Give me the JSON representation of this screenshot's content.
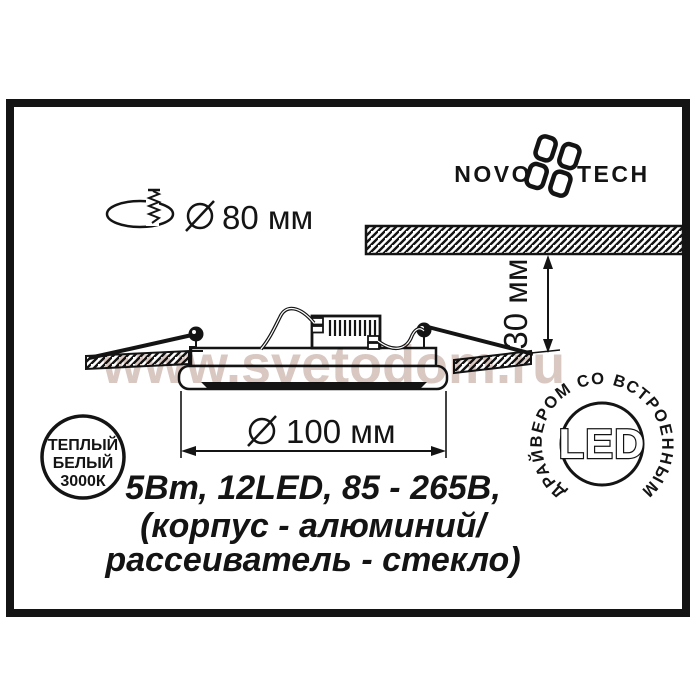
{
  "logo": {
    "word_left": "NOVO",
    "word_right": "TECH"
  },
  "dimensions": {
    "cutout_label": "80 мм",
    "depth_label": "30 мм",
    "width_label": "100 мм"
  },
  "specs": {
    "line1": "5Вт, 12LED, 85 - 265В,",
    "line2": "(корпус - алюминий/",
    "line3": "рассеиватель - стекло)"
  },
  "warm_badge": {
    "line1": "ТЕПЛЫЙ",
    "line2": "БЕЛЫЙ",
    "line3": "3000К"
  },
  "led_badge": {
    "center": "LED",
    "ring": "ДРАЙВЕРОМ СО ВСТРОЕННЫМ"
  },
  "watermark": {
    "text": "www.svetodom.ru"
  },
  "colors": {
    "ink": "#141414",
    "watermark": "#d9c8c2"
  }
}
